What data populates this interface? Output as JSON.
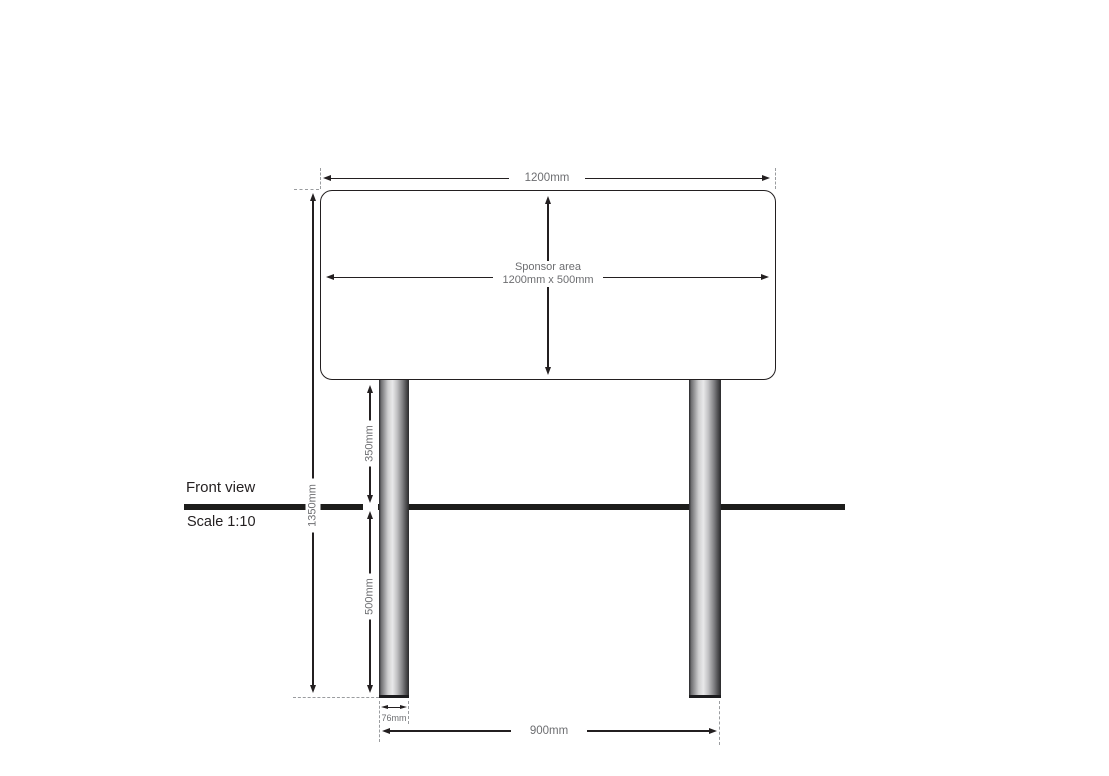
{
  "drawing": {
    "view_label": "Front view",
    "scale_label": "Scale 1:10",
    "panel": {
      "width_dim": "1200mm",
      "sponsor_line1": "Sponsor area",
      "sponsor_line2": "1200mm x 500mm"
    },
    "dimensions": {
      "overall_height": "1350mm",
      "post_above_ground": "350mm",
      "post_below_ground": "500mm",
      "post_width": "76mm",
      "post_spacing": "900mm"
    },
    "colors": {
      "dimension_line": "#231f20",
      "dimension_text": "#6d6e71",
      "ground_line": "#1d1d1b",
      "extension_dash": "#9a9c9f",
      "background": "#ffffff"
    }
  }
}
